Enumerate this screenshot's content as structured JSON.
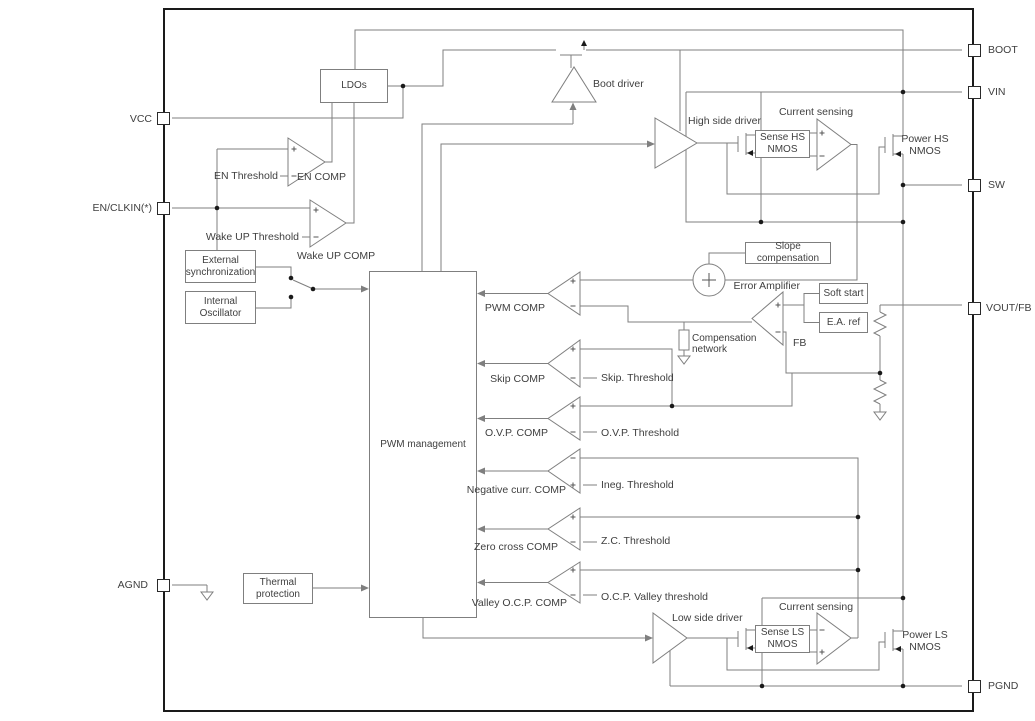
{
  "colors": {
    "background": "#ffffff",
    "wire": "#7f7f7f",
    "text": "#3f3f3f",
    "chip_border": "#1a1a1a"
  },
  "pins": {
    "left": [
      {
        "id": "vcc",
        "label": "VCC"
      },
      {
        "id": "en-clkin",
        "label": "EN/CLKIN(*)"
      },
      {
        "id": "agnd",
        "label": "AGND"
      }
    ],
    "right": [
      {
        "id": "boot",
        "label": "BOOT"
      },
      {
        "id": "vin",
        "label": "VIN"
      },
      {
        "id": "sw",
        "label": "SW"
      },
      {
        "id": "vout-fb",
        "label": "VOUT/FB"
      },
      {
        "id": "pgnd",
        "label": "PGND"
      }
    ]
  },
  "blocks": {
    "ldos": {
      "label": "LDOs"
    },
    "external_sync": {
      "lines": [
        "External",
        "synchronization"
      ]
    },
    "internal_osc": {
      "lines": [
        "Internal",
        "Oscillator"
      ]
    },
    "pwm_management": {
      "label": "PWM management"
    },
    "slope_compensation": {
      "label": "Slope compensation"
    },
    "soft_start": {
      "label": "Soft start"
    },
    "ea_ref": {
      "label": "E.A. ref"
    },
    "thermal_protection": {
      "lines": [
        "Thermal",
        "protection"
      ]
    },
    "sense_hs_nmos": {
      "lines": [
        "Sense HS",
        "NMOS"
      ]
    },
    "sense_ls_nmos": {
      "lines": [
        "Sense LS",
        "NMOS"
      ]
    },
    "power_hs_nmos": {
      "lines": [
        "Power HS",
        "NMOS"
      ]
    },
    "power_ls_nmos": {
      "lines": [
        "Power LS",
        "NMOS"
      ]
    }
  },
  "labels": {
    "boot_driver": "Boot driver",
    "en_threshold": "EN Threshold",
    "en_comp": "EN COMP",
    "wake_up_threshold": "Wake UP Threshold",
    "wake_up_comp": "Wake UP COMP",
    "high_side_driver": "High side driver",
    "low_side_driver": "Low side driver",
    "current_sensing_hs": "Current sensing",
    "current_sensing_ls": "Current sensing",
    "error_amplifier": "Error Amplifier",
    "fb": "FB",
    "compensation_network": {
      "lines": [
        "Compensation",
        "network"
      ]
    }
  },
  "comparators": {
    "pwm": {
      "label": "PWM COMP"
    },
    "skip": {
      "label": "Skip COMP",
      "threshold": "Skip. Threshold"
    },
    "ovp": {
      "label": "O.V.P. COMP",
      "threshold": "O.V.P. Threshold"
    },
    "negative_current": {
      "label": "Negative curr. COMP",
      "threshold": "Ineg. Threshold"
    },
    "zero_cross": {
      "label": "Zero cross COMP",
      "threshold": "Z.C. Threshold"
    },
    "valley_ocp": {
      "label": "Valley O.C.P. COMP",
      "threshold": "O.C.P. Valley threshold"
    }
  }
}
